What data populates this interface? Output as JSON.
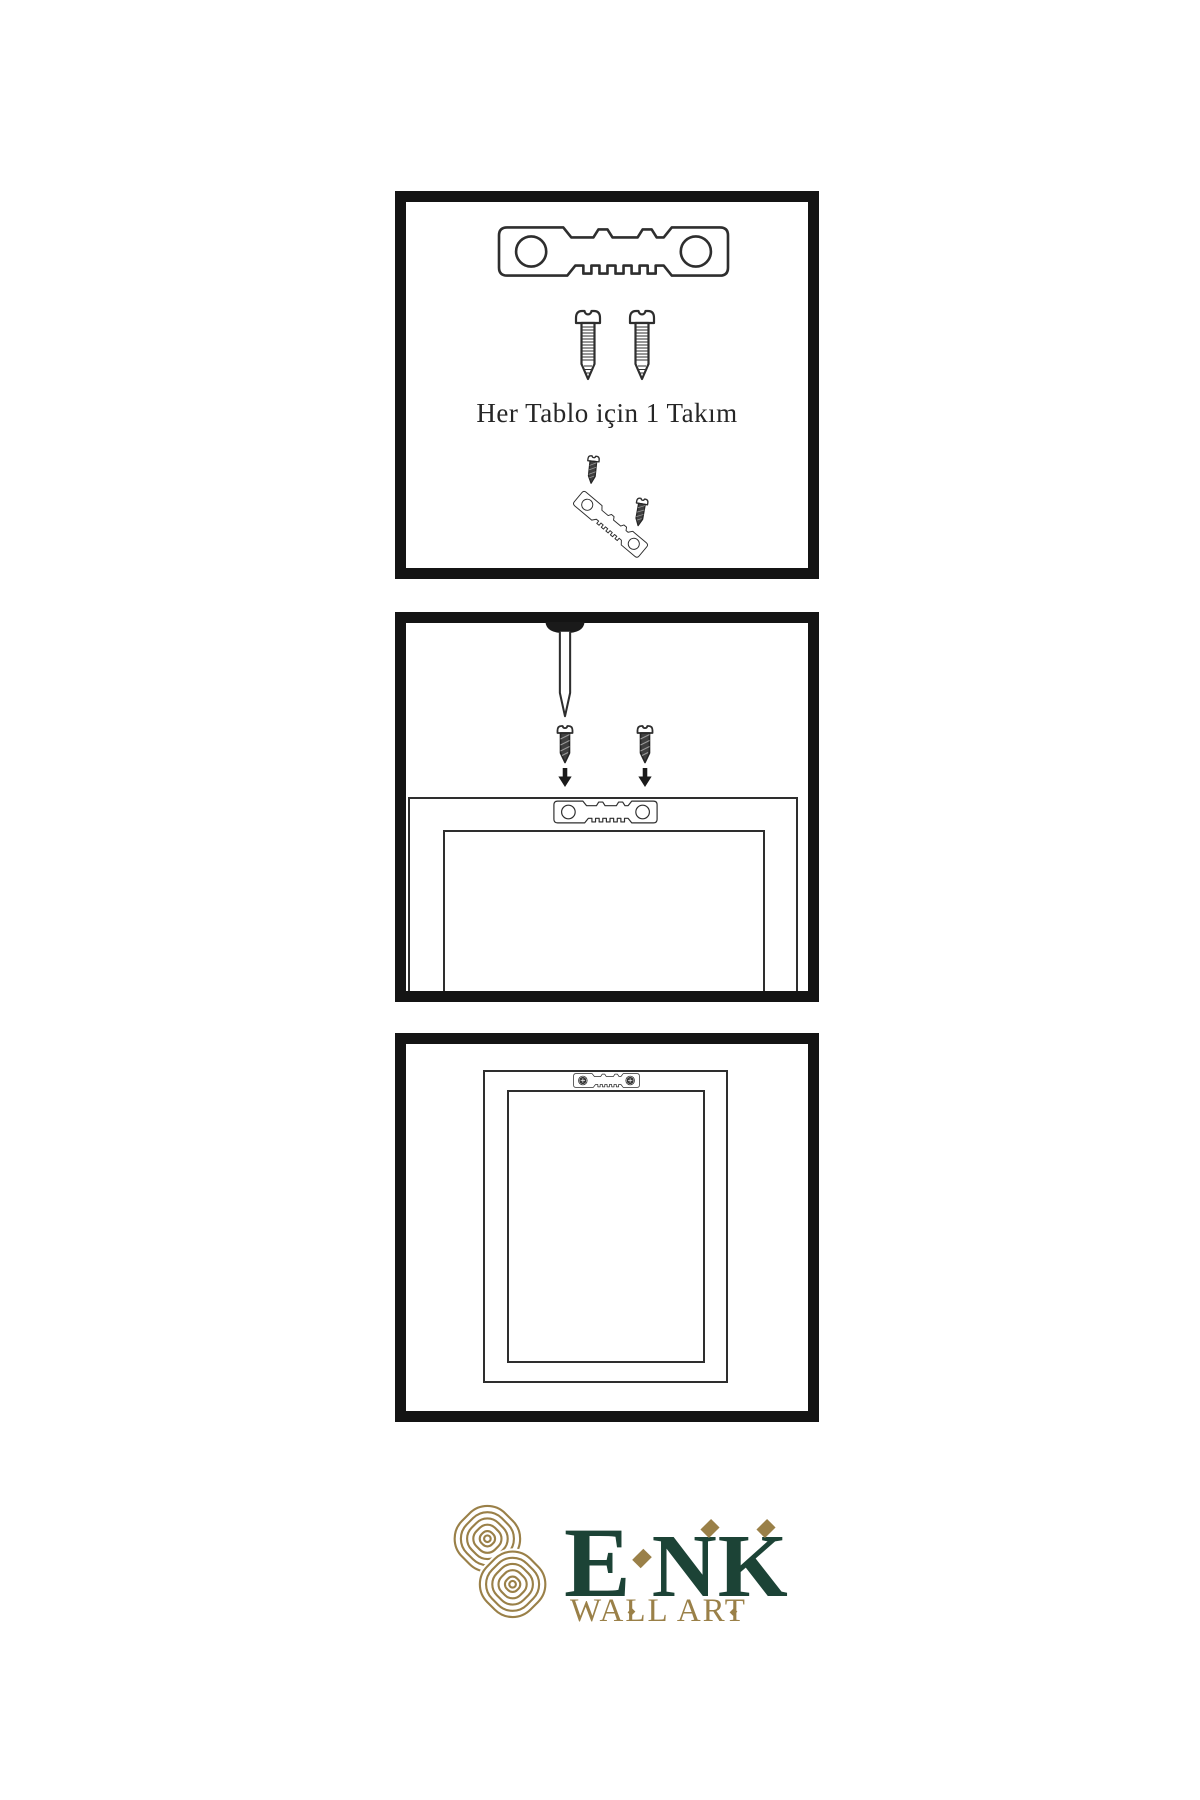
{
  "colors": {
    "background": "#ffffff",
    "panel_border": "#141414",
    "line": "#2e2e2e",
    "hardware_dark": "#3f3f3f",
    "brand_green": "#1c4336",
    "brand_gold": "#9a8048"
  },
  "kit_panel": {
    "caption": "Her Tablo için 1 Takım",
    "icons": [
      "sawtooth-hanger-icon",
      "screw-icon",
      "screw-icon",
      "screw-small-icon",
      "sawtooth-hanger-angled-icon",
      "screw-small-icon"
    ]
  },
  "install_panel": {
    "icons": [
      "nail-icon",
      "screw-icon",
      "screw-icon",
      "arrow-down-icon",
      "arrow-down-icon",
      "frame-back-icon",
      "sawtooth-hanger-icon"
    ]
  },
  "hang_panel": {
    "icons": [
      "frame-back-icon",
      "sawtooth-hanger-mounted-icon"
    ]
  },
  "logo": {
    "letters": [
      "E",
      "N",
      "K"
    ],
    "subtitle": "WALL ART"
  }
}
